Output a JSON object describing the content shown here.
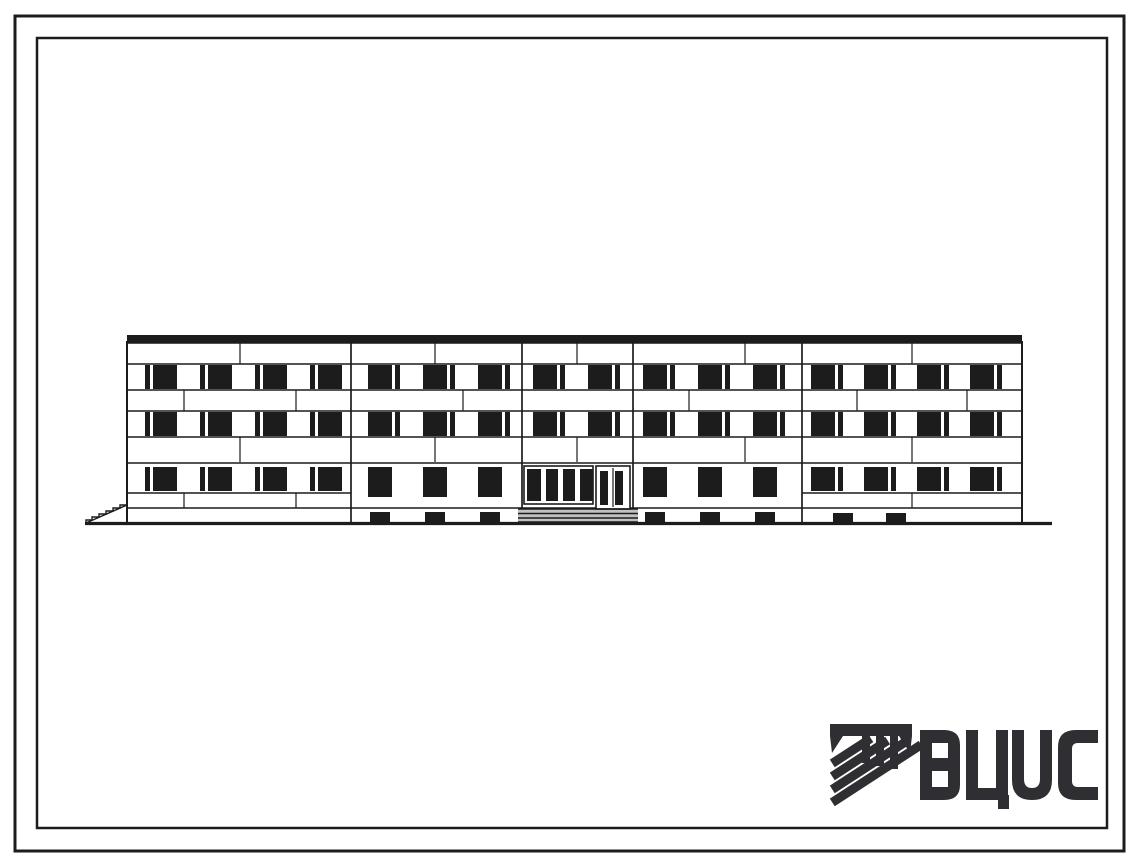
{
  "sheet": {
    "description": "Typical-design architectural drawing: main facade elevation of a 3-storey rectangular building",
    "floors": 3,
    "colors": {
      "paper": "#ffffff",
      "ink": "#1c1c1c",
      "logo_ink": "#2e2e33"
    }
  },
  "logo": {
    "text": "ВЦИС",
    "letters": [
      "В",
      "Ц",
      "И",
      "С"
    ],
    "emblem": "hatched-monogram"
  },
  "building": {
    "outline": {
      "left": 127,
      "right": 1022,
      "parapet_top": 335,
      "wall_top": 342,
      "base": 524
    },
    "ground_line": {
      "x1": 85,
      "x2": 1052,
      "y": 523.5
    },
    "h_lines": [
      343,
      364,
      390,
      411,
      437,
      463,
      508
    ],
    "h_line_segments": [
      {
        "x1": 127,
        "x2": 351,
        "y": 493
      },
      {
        "x1": 802,
        "x2": 1022,
        "y": 493
      }
    ],
    "v_joints": [
      {
        "x": 351,
        "y1": 342,
        "y2": 524
      },
      {
        "x": 522,
        "y1": 342,
        "y2": 509
      },
      {
        "x": 633,
        "y1": 342,
        "y2": 509
      },
      {
        "x": 802,
        "y1": 342,
        "y2": 524
      }
    ],
    "band_joints": [
      {
        "y1": 343,
        "y2": 364,
        "xs": [
          240,
          435,
          577,
          745,
          912
        ]
      },
      {
        "y1": 390,
        "y2": 411,
        "xs": [
          184,
          296,
          463,
          689,
          857,
          967
        ]
      },
      {
        "y1": 437,
        "y2": 462,
        "xs": [
          240,
          435,
          577,
          745,
          912
        ]
      },
      {
        "y1": 493,
        "y2": 508,
        "xs": [
          184,
          296,
          912
        ]
      }
    ],
    "window_rects": [
      [
        145,
        365,
        5,
        24
      ],
      [
        153,
        365,
        24,
        24
      ],
      [
        200,
        365,
        5,
        24
      ],
      [
        208,
        365,
        24,
        24
      ],
      [
        255,
        365,
        5,
        24
      ],
      [
        263,
        365,
        24,
        24
      ],
      [
        310,
        365,
        5,
        24
      ],
      [
        318,
        365,
        24,
        24
      ],
      [
        368,
        365,
        24,
        24
      ],
      [
        395,
        365,
        5,
        24
      ],
      [
        423,
        365,
        24,
        24
      ],
      [
        450,
        365,
        5,
        24
      ],
      [
        478,
        365,
        24,
        24
      ],
      [
        505,
        365,
        5,
        24
      ],
      [
        533,
        365,
        24,
        24
      ],
      [
        560,
        365,
        5,
        24
      ],
      [
        588,
        365,
        24,
        24
      ],
      [
        615,
        365,
        5,
        24
      ],
      [
        643,
        365,
        24,
        24
      ],
      [
        670,
        365,
        5,
        24
      ],
      [
        698,
        365,
        24,
        24
      ],
      [
        725,
        365,
        5,
        24
      ],
      [
        753,
        365,
        24,
        24
      ],
      [
        780,
        365,
        5,
        24
      ],
      [
        811,
        365,
        24,
        24
      ],
      [
        838,
        365,
        5,
        24
      ],
      [
        864,
        365,
        24,
        24
      ],
      [
        891,
        365,
        5,
        24
      ],
      [
        917,
        365,
        24,
        24
      ],
      [
        944,
        365,
        5,
        24
      ],
      [
        970,
        365,
        24,
        24
      ],
      [
        997,
        365,
        5,
        24
      ],
      [
        145,
        412,
        5,
        24
      ],
      [
        153,
        412,
        24,
        24
      ],
      [
        200,
        412,
        5,
        24
      ],
      [
        208,
        412,
        24,
        24
      ],
      [
        255,
        412,
        5,
        24
      ],
      [
        263,
        412,
        24,
        24
      ],
      [
        310,
        412,
        5,
        24
      ],
      [
        318,
        412,
        24,
        24
      ],
      [
        368,
        412,
        24,
        24
      ],
      [
        395,
        412,
        5,
        24
      ],
      [
        423,
        412,
        24,
        24
      ],
      [
        450,
        412,
        5,
        24
      ],
      [
        478,
        412,
        24,
        24
      ],
      [
        505,
        412,
        5,
        24
      ],
      [
        533,
        412,
        24,
        24
      ],
      [
        560,
        412,
        5,
        24
      ],
      [
        588,
        412,
        24,
        24
      ],
      [
        615,
        412,
        5,
        24
      ],
      [
        643,
        412,
        24,
        24
      ],
      [
        670,
        412,
        5,
        24
      ],
      [
        698,
        412,
        24,
        24
      ],
      [
        725,
        412,
        5,
        24
      ],
      [
        753,
        412,
        24,
        24
      ],
      [
        780,
        412,
        5,
        24
      ],
      [
        811,
        412,
        24,
        24
      ],
      [
        838,
        412,
        5,
        24
      ],
      [
        864,
        412,
        24,
        24
      ],
      [
        891,
        412,
        5,
        24
      ],
      [
        917,
        412,
        24,
        24
      ],
      [
        944,
        412,
        5,
        24
      ],
      [
        970,
        412,
        24,
        24
      ],
      [
        997,
        412,
        5,
        24
      ],
      [
        145,
        467,
        5,
        24
      ],
      [
        153,
        467,
        24,
        24
      ],
      [
        200,
        467,
        5,
        24
      ],
      [
        208,
        467,
        24,
        24
      ],
      [
        255,
        467,
        5,
        24
      ],
      [
        263,
        467,
        24,
        24
      ],
      [
        310,
        467,
        5,
        24
      ],
      [
        318,
        467,
        24,
        24
      ],
      [
        368,
        467,
        24,
        30
      ],
      [
        423,
        467,
        24,
        30
      ],
      [
        478,
        467,
        24,
        30
      ],
      [
        643,
        467,
        24,
        30
      ],
      [
        698,
        467,
        24,
        30
      ],
      [
        753,
        467,
        24,
        30
      ],
      [
        811,
        467,
        24,
        24
      ],
      [
        838,
        467,
        5,
        24
      ],
      [
        864,
        467,
        24,
        24
      ],
      [
        891,
        467,
        5,
        24
      ],
      [
        917,
        467,
        24,
        24
      ],
      [
        944,
        467,
        5,
        24
      ],
      [
        970,
        467,
        24,
        24
      ],
      [
        997,
        467,
        5,
        24
      ]
    ],
    "basement_rects": [
      [
        370,
        512,
        20,
        11
      ],
      [
        425,
        512,
        20,
        11
      ],
      [
        480,
        512,
        20,
        11
      ],
      [
        645,
        512,
        20,
        11
      ],
      [
        700,
        512,
        20,
        11
      ],
      [
        755,
        512,
        20,
        11
      ],
      [
        833,
        513,
        20,
        10
      ],
      [
        886,
        513,
        20,
        10
      ]
    ],
    "entrance": {
      "glazing": {
        "x": 524,
        "y": 466,
        "w": 69,
        "h": 38,
        "panes": [
          [
            527,
            469,
            14,
            32
          ],
          [
            546,
            469,
            12,
            32
          ],
          [
            563,
            469,
            12,
            32
          ],
          [
            580,
            469,
            13,
            32
          ]
        ]
      },
      "door": {
        "x": 596,
        "y": 466,
        "w": 34,
        "h": 43,
        "panes": [
          [
            600,
            471,
            8,
            34
          ],
          [
            615,
            471,
            8,
            34
          ]
        ]
      },
      "steps": {
        "x": 518,
        "y": 509,
        "w": 120,
        "h": 16,
        "line_ys": [
          509,
          513.5,
          518,
          522
        ]
      }
    },
    "terrain": {
      "diagonal": [
        [
          86,
          523
        ],
        [
          127,
          505
        ]
      ],
      "steps_path": "M127,505 L120,505 L120,508 L113,508 L113,511 L106,511 L106,514 L99,514 L99,517 L92,517 L92,520 L86,520 L86,523"
    }
  },
  "frames": {
    "outer": {
      "x": 15,
      "y": 16,
      "w": 1109,
      "h": 835,
      "stroke_width": 3
    },
    "inner": {
      "x": 37,
      "y": 38,
      "w": 1070,
      "h": 790,
      "stroke_width": 2.5
    }
  }
}
